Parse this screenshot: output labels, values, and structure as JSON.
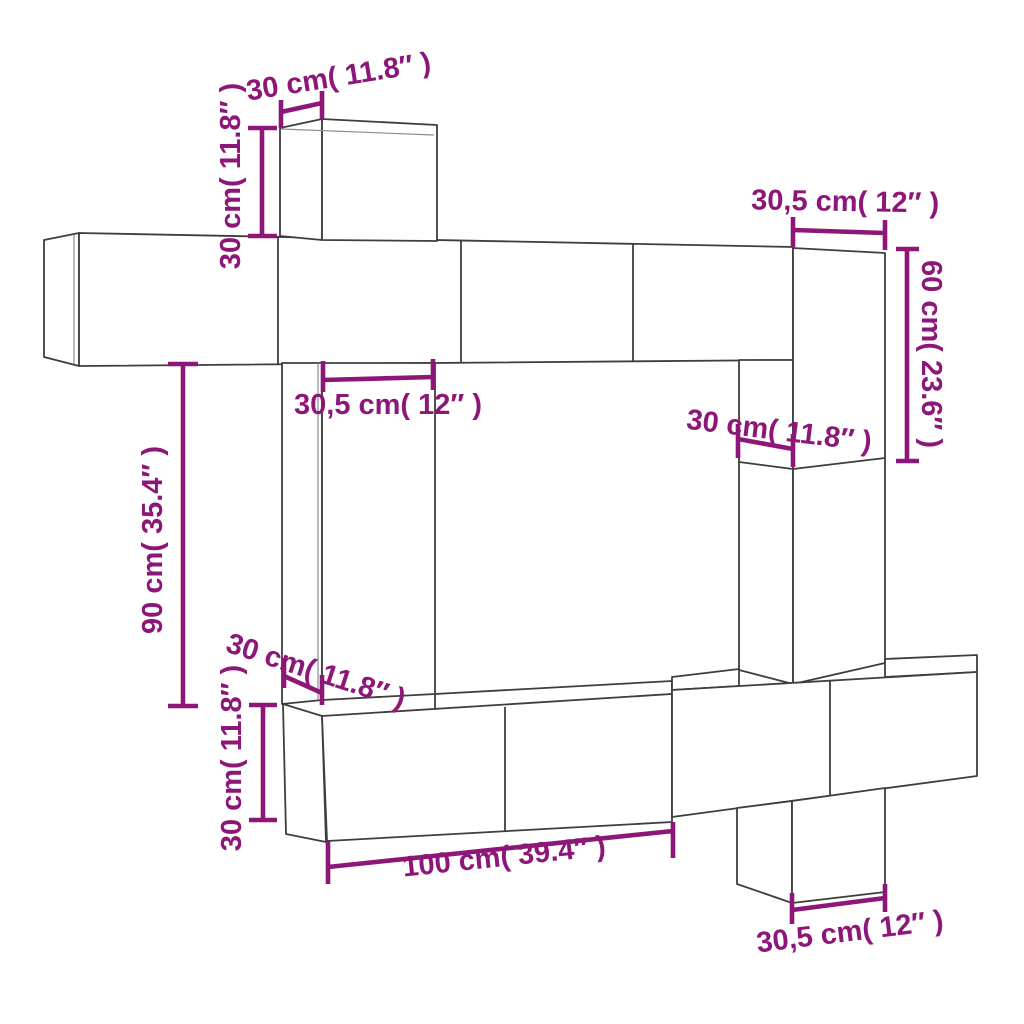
{
  "diagram": {
    "kind": "furniture-dimension-diagram",
    "colors": {
      "background": "#ffffff",
      "outline": "#3e3e3e",
      "dimension": "#8d1778"
    },
    "dimensions": [
      {
        "id": "top-box-depth",
        "cm": "30",
        "inches": "11.8",
        "label": "30 cm( 11.8″ )"
      },
      {
        "id": "top-box-height",
        "cm": "30",
        "inches": "11.8",
        "label": "30 cm( 11.8″ )"
      },
      {
        "id": "right-box-width",
        "cm": "30,5",
        "inches": "12",
        "label": "30,5 cm( 12″ )"
      },
      {
        "id": "right-box-height",
        "cm": "60",
        "inches": "23.6",
        "label": "60 cm( 23.6″ )"
      },
      {
        "id": "left-column-width",
        "cm": "30,5",
        "inches": "12",
        "label": "30,5 cm( 12″ )"
      },
      {
        "id": "right-column-depth",
        "cm": "30",
        "inches": "11.8",
        "label": "30 cm( 11.8″ )"
      },
      {
        "id": "left-column-height",
        "cm": "90",
        "inches": "35.4",
        "label": "90 cm( 35.4″ )"
      },
      {
        "id": "bottom-cabinet-depth",
        "cm": "30",
        "inches": "11.8",
        "label": "30 cm( 11.8″ )"
      },
      {
        "id": "bottom-cabinet-height",
        "cm": "30",
        "inches": "11.8",
        "label": "30 cm( 11.8″ )"
      },
      {
        "id": "tv-bench-width",
        "cm": "100",
        "inches": "39.4",
        "label": "100 cm( 39.4″ )"
      },
      {
        "id": "hanging-cabinet-width",
        "cm": "30,5",
        "inches": "12",
        "label": "30,5 cm( 12″ )"
      }
    ]
  }
}
